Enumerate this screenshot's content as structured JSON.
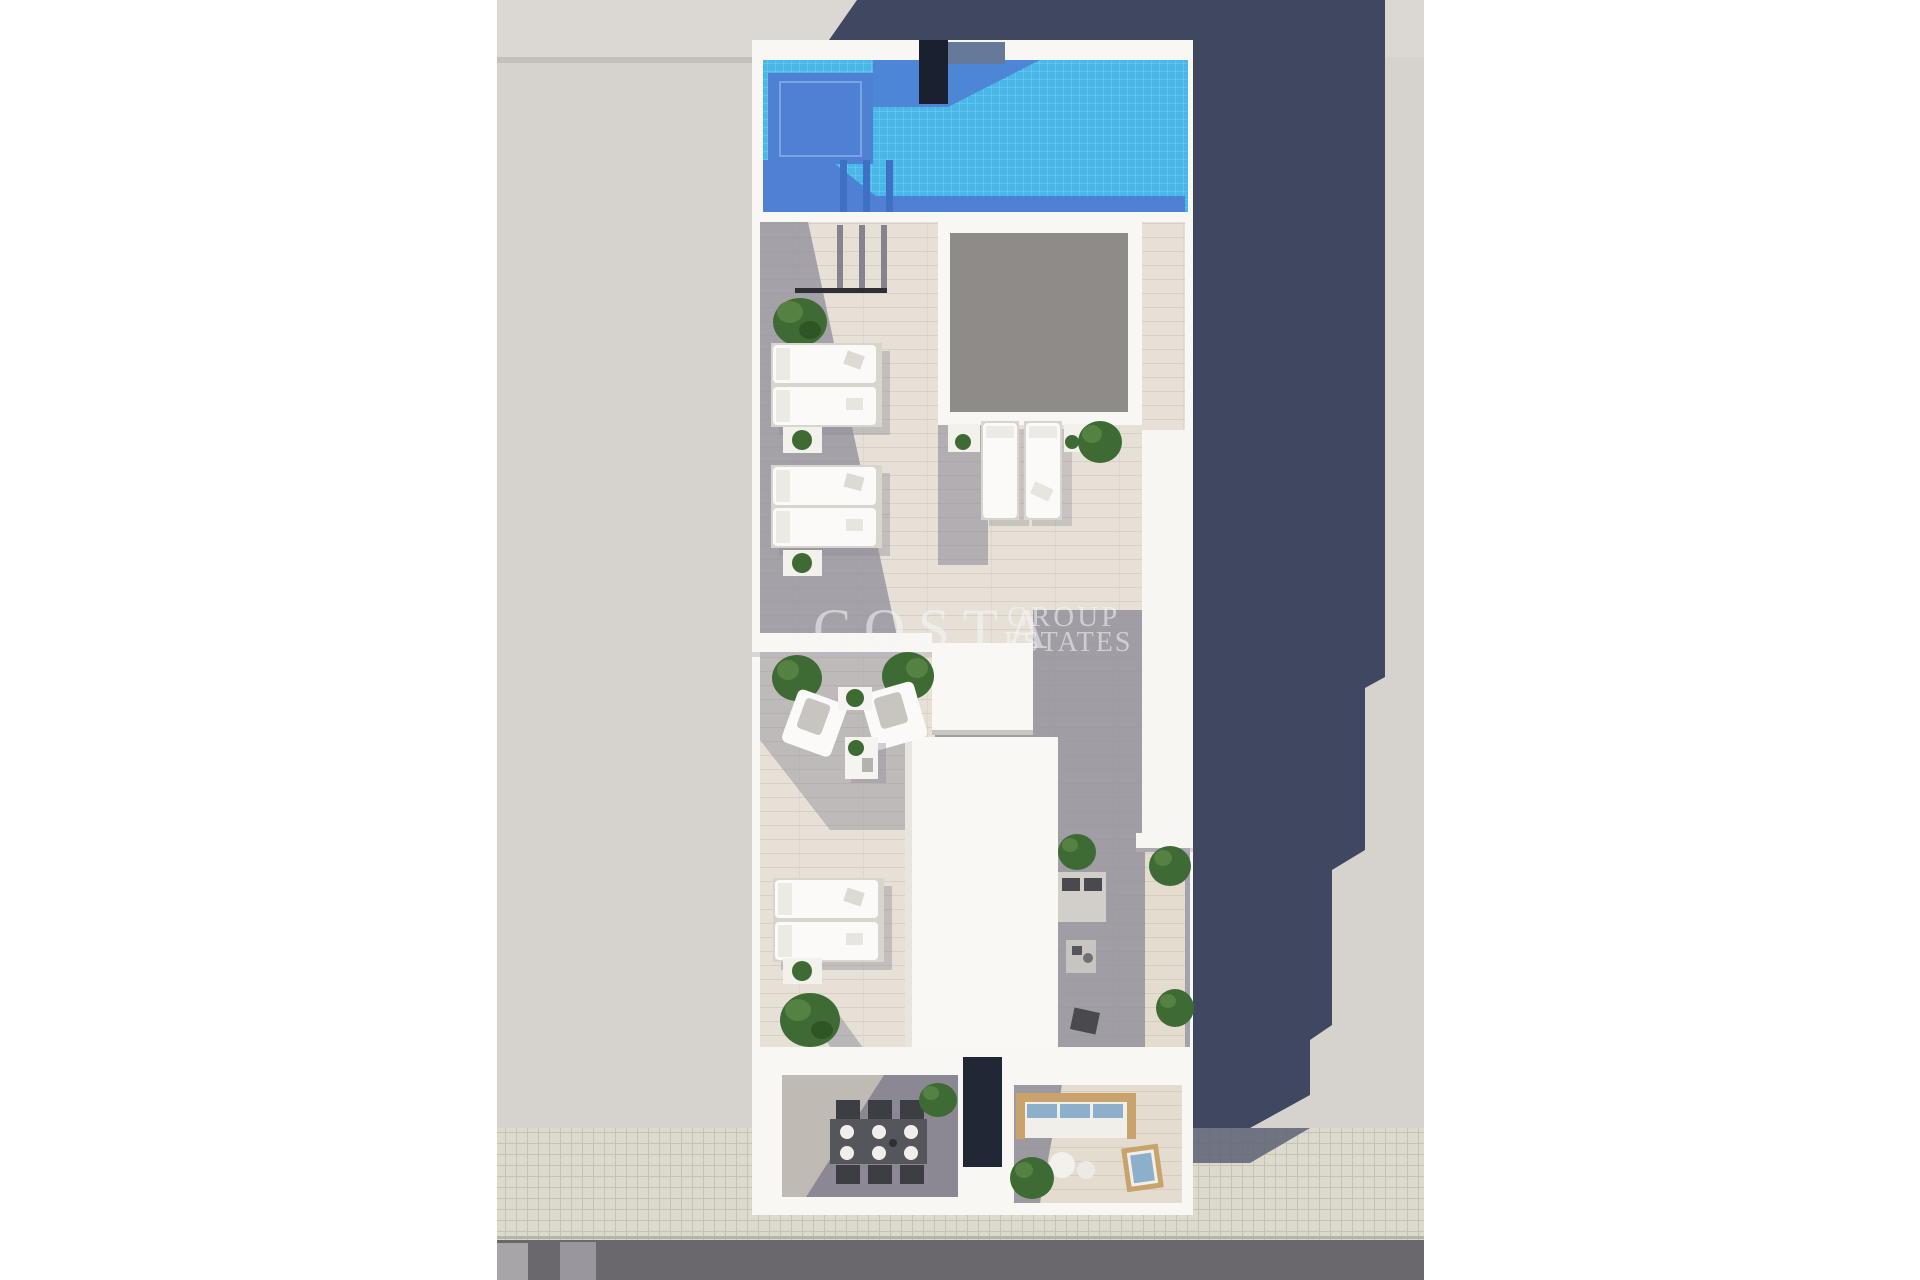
{
  "watermark": {
    "line1": "COSTA",
    "line2": "GROUP",
    "line3": "ESTATES",
    "color": "rgba(246,246,250,0.55)"
  },
  "palette": {
    "canvas_white": "#ffffff",
    "neighbor_gray": "#d6d3ce",
    "neighbor_gray_light": "#dbd8d3",
    "shadow_navy": "#404760",
    "wall_white": "#f8f7f4",
    "pool_blue": "#49b8e8",
    "pool_shadow_blue": "#4e81d3",
    "pool_dark_core": "#1a2030",
    "pool_gray_blue": "#66799b",
    "deck_light": "#e7e0d6",
    "deck_shadow": "#8f8c98",
    "skylight_gray": "#8e8b88",
    "terrace_floor_gray": "#8b8894",
    "furniture_white": "#fbfaf8",
    "cushion_gray": "#c8c5c0",
    "plant_green_dark": "#3e6b34",
    "plant_green_light": "#558243",
    "dining_table_gray": "#55565c",
    "chair_dark": "#3c3e44",
    "cushion_blue": "#8cb0cc",
    "wood_tan": "#c9a36b",
    "sidewalk_tile": "#dcd9cd",
    "tile_grout": "#c6c3b6",
    "road_gray": "#6b686d",
    "road_marking": "#a8a5a9"
  }
}
